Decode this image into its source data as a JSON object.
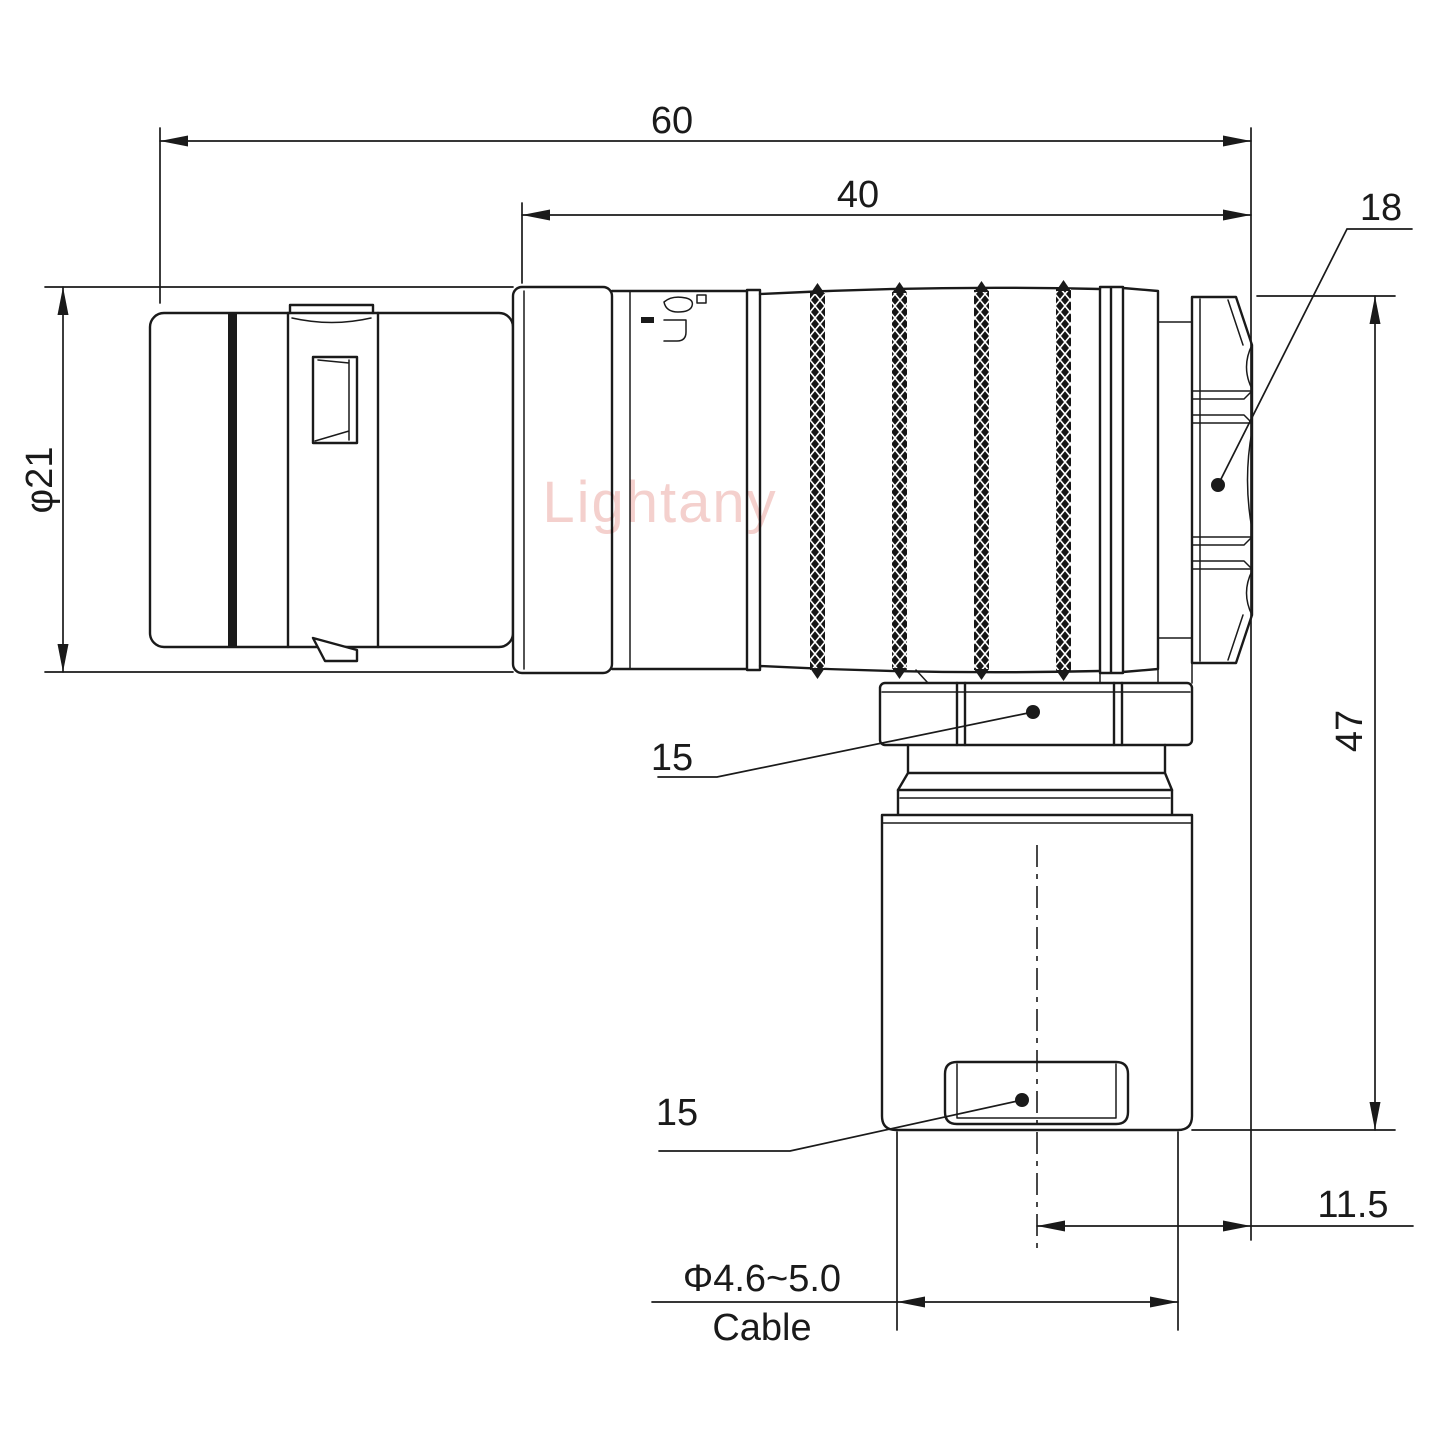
{
  "page": {
    "background": "#ffffff"
  },
  "watermark": {
    "text": "Lightany",
    "color": "#f4d0cd"
  },
  "colors": {
    "line": "#1a1a1a"
  },
  "dimensions": {
    "overall_length": "60",
    "rear_body_length": "40",
    "backnut_across_flats": "18",
    "shell_diameter": "φ21",
    "overall_height": "47",
    "coupling_nut_size": "15",
    "cable_clamp_size": "15",
    "outlet_offset": "11.5",
    "cable_range": "Φ4.6~5.0",
    "cable_word": "Cable"
  }
}
